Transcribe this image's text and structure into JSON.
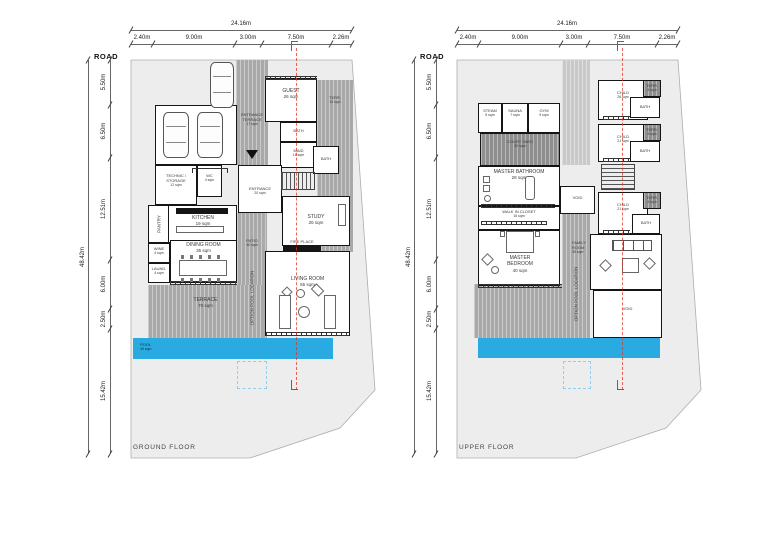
{
  "dimensions": {
    "road_label": "ROAD",
    "overall_width": "24.16m",
    "top_segments": [
      "2.40m",
      "9.00m",
      "3.00m",
      "7.50m",
      "2.26m"
    ],
    "overall_height": "48.42m",
    "left_segments": [
      "5.50m",
      "6.50m",
      "12.51m",
      "6.00m",
      "2.50m",
      "15.42m"
    ]
  },
  "ground_floor": {
    "title": "GROUND FLOOR",
    "rooms": {
      "entrance_terrace": {
        "name": "ENTRANCE TERRACE",
        "area": "17 sqm"
      },
      "guest": {
        "name": "GUEST",
        "area": "26 sqm"
      },
      "terrace_side": {
        "name": "TERR.",
        "area": "15 sqm"
      },
      "bath": {
        "name": "BATH"
      },
      "maid": {
        "name": "MAID",
        "area": "16 sqm"
      },
      "technic_storage": {
        "name": "TECHNIC / STORAGE",
        "area": "12 sqm"
      },
      "wc": {
        "name": "WC",
        "area": "4 sqm"
      },
      "entrance": {
        "name": "ENTRANCE",
        "area": "20 sqm"
      },
      "pantry": {
        "name": "PANTRY",
        "area": "7 sqm"
      },
      "kitchen": {
        "name": "KITCHEN",
        "area": "19 sqm"
      },
      "dining_room": {
        "name": "DINING ROOM",
        "area": "35 sqm"
      },
      "wine": {
        "name": "WINE",
        "area": "4 sqm"
      },
      "laundry": {
        "name": "LAUND.",
        "area": "4 sqm"
      },
      "patio": {
        "name": "PATIO",
        "area": "40 sqm"
      },
      "study": {
        "name": "STUDY",
        "area": "26 sqm"
      },
      "fire_place": {
        "name": "FIRE PLACE"
      },
      "living_room": {
        "name": "LIVING ROOM",
        "area": "65 sqm"
      },
      "terrace": {
        "name": "TERRACE",
        "area": "70 sqm"
      },
      "pool": {
        "name": "POOL",
        "area": "49 sqm"
      },
      "option_pool": {
        "name": "OPTION POOL LOCATION"
      }
    }
  },
  "upper_floor": {
    "title": "UPPER FLOOR",
    "rooms": {
      "steam": {
        "name": "STEAM",
        "area": "5 sqm"
      },
      "sauna": {
        "name": "SAUNA",
        "area": "7 sqm"
      },
      "gym": {
        "name": "GYM",
        "area": "9 sqm"
      },
      "court_yard": {
        "name": "COURT YARD",
        "area": "30 sqm"
      },
      "master_bathroom": {
        "name": "MASTER BATHROOM",
        "area": "28 sqm"
      },
      "walk_in_closet": {
        "name": "WALK IN CLOSET",
        "area": "16 sqm"
      },
      "master_bedroom": {
        "name": "MASTER BEDROOM",
        "area": "40 sqm"
      },
      "child_large": {
        "name": "CHILD",
        "area": "26 sqm"
      },
      "child_small": {
        "name": "CHILD",
        "area": "21 sqm"
      },
      "terrace_small": {
        "name": "TERR.",
        "area": "4 sqm"
      },
      "bath": {
        "name": "BATH"
      },
      "family_room": {
        "name": "FAMILY ROOM",
        "area": "39 sqm"
      },
      "void": {
        "name": "VOID"
      },
      "option_pool": {
        "name": "OPTION POOL LOCATION"
      }
    }
  },
  "colors": {
    "pool": "#29abe2",
    "section_marker": "#e5311f",
    "site_fill": "#ededed",
    "terrace_gray": "#a9a9a9",
    "court_gray": "#8e8e8e",
    "option_dash": "#8fd0ef"
  }
}
